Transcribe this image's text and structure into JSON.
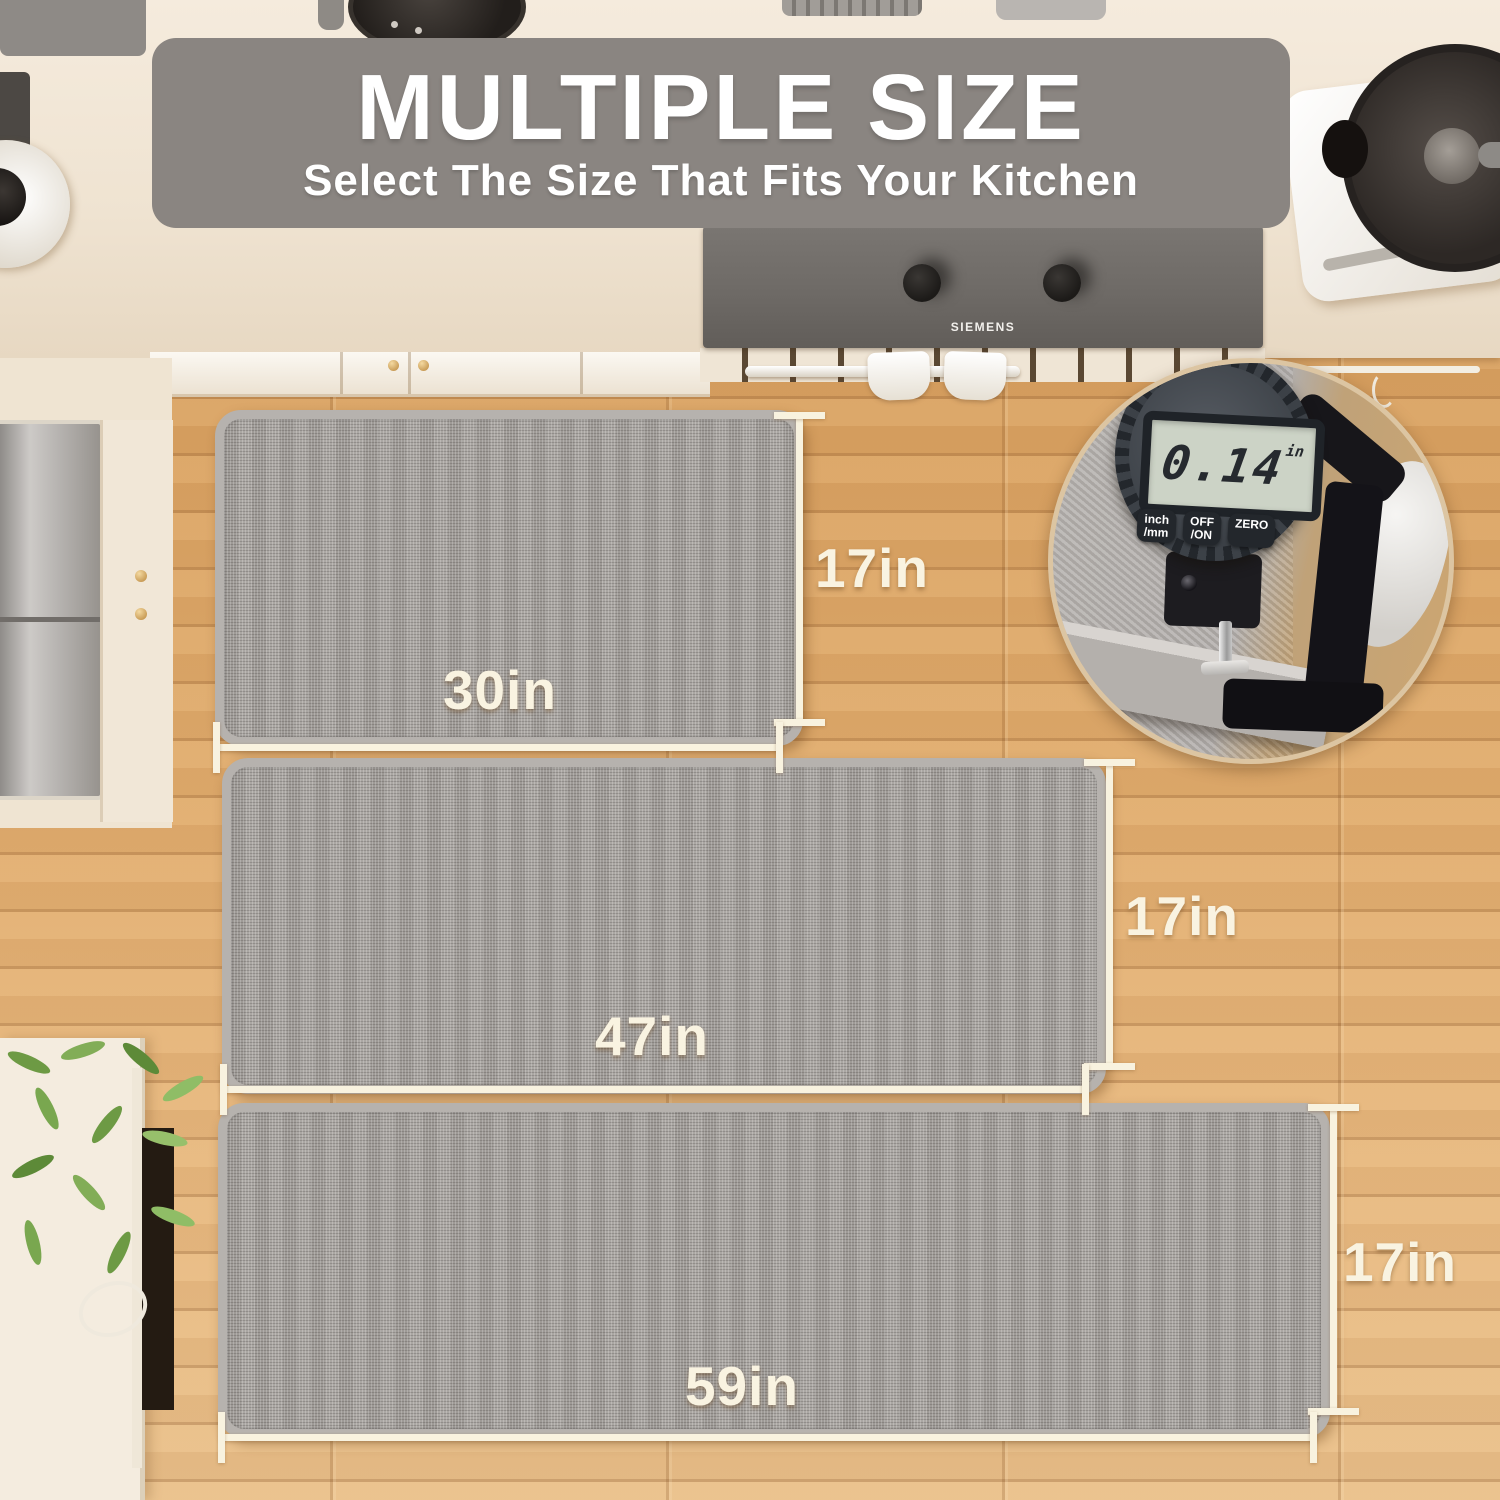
{
  "banner": {
    "title": "MULTIPLE SIZE",
    "subtitle": "Select The Size That Fits Your Kitchen",
    "bg_color": "#8a8581",
    "text_color": "#ffffff"
  },
  "mats": [
    {
      "width_label": "30in",
      "height_label": "17in"
    },
    {
      "width_label": "47in",
      "height_label": "17in"
    },
    {
      "width_label": "59in",
      "height_label": "17in"
    }
  ],
  "inset": {
    "reading": "0.14",
    "unit": "in",
    "buttons": [
      "inch\n/mm",
      "OFF\n/ON",
      "ZERO"
    ]
  },
  "cooktop": {
    "brand": "SIEMENS"
  },
  "colors": {
    "banner_bg": "#8a8581",
    "dimension_lines": "#f8f2df",
    "mat_gray": "#a6a29e",
    "mat_border": "#b6b2ae",
    "wood_floor": "#dca76a",
    "counter": "#efe3d1",
    "cooktop": "#6e6a66"
  }
}
